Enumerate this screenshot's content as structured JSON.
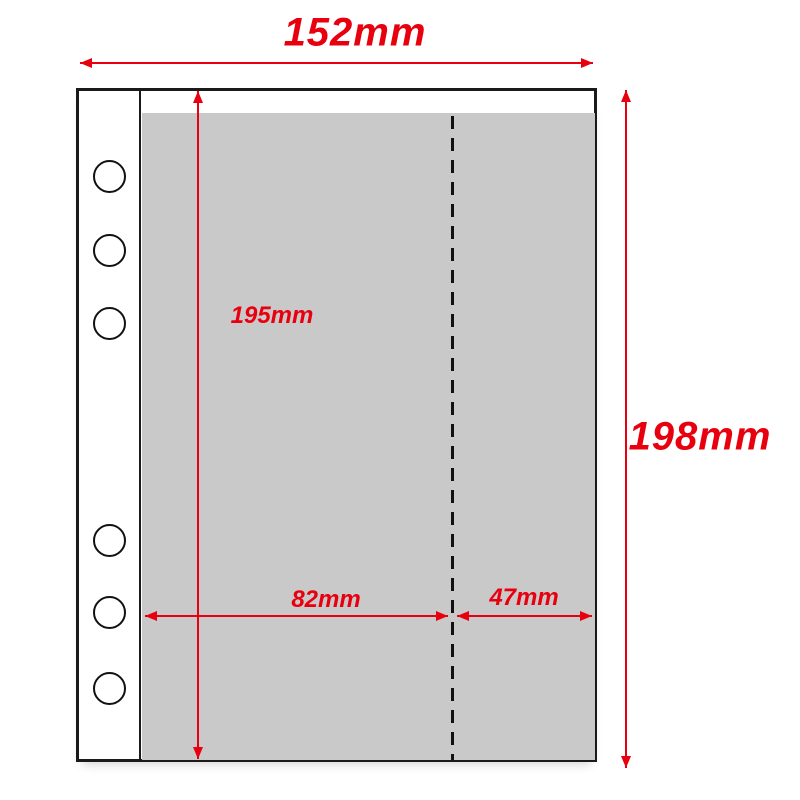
{
  "diagram": {
    "kind": "binder-refill-page-dimension-diagram",
    "dimensions": {
      "total_width": "152mm",
      "total_height": "198mm",
      "pocket_height": "195mm",
      "pocket_left_width": "82mm",
      "pocket_right_width": "47mm"
    },
    "holes_count": 6,
    "colors": {
      "dimension_red": "#e8000f",
      "outline_black": "#1a1a1a",
      "pocket_gray": "#c9c9c9",
      "page_white": "#ffffff"
    }
  }
}
